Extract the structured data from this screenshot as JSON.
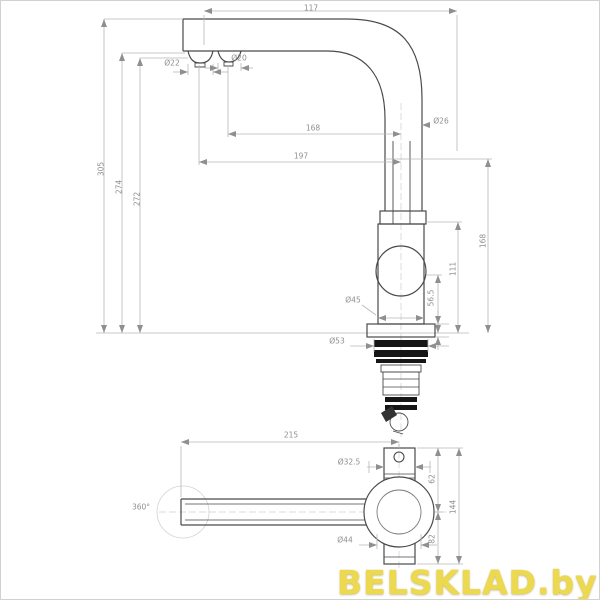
{
  "watermark": {
    "text": "BELSKLAD.by",
    "color": "#ecd94f"
  },
  "side_view": {
    "labels": {
      "top_width": "117",
      "aerator_left_diameter": "Ø22",
      "aerator_right_diameter": "Ø20",
      "spout_pipe_diameter": "Ø26",
      "reach_inner": "168",
      "reach_outer": "197",
      "height_total": "305",
      "height_to_spout": "274",
      "height_to_aerator": "272",
      "right_height_upper": "168",
      "right_height_mid": "111",
      "right_height_lower": "56.5",
      "body_diameter": "Ø45",
      "base_diameter": "Ø53"
    }
  },
  "top_view": {
    "labels": {
      "spout_length": "215",
      "base_width": "Ø32.5",
      "swivel_angle": "360°",
      "base_circle_diameter": "Ø44",
      "offset_top": "62",
      "height_total": "144",
      "offset_bottom": "82"
    }
  }
}
